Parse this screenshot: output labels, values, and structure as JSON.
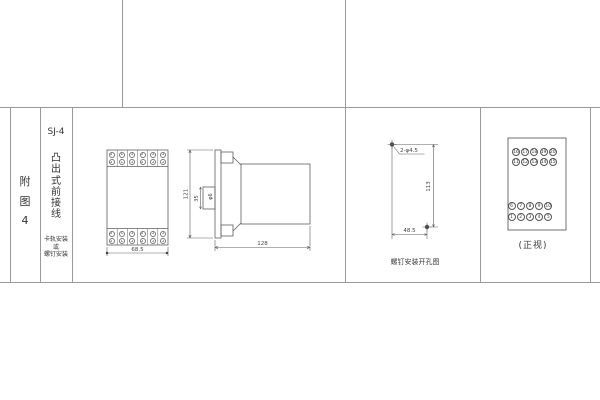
{
  "title_block": {
    "figure_label": "附图4",
    "model": "SJ-4",
    "type_label": "凸出式前接线",
    "mount_note_lines": [
      "卡轨安装",
      "或",
      "螺钉安装"
    ]
  },
  "front_view": {
    "width_dim": "68.5"
  },
  "side_view": {
    "height_dim": "121",
    "clip_height_dim": "35",
    "clip_hole_label": "φ6",
    "depth_dim": "128"
  },
  "drill_view": {
    "holes_label": "2-φ4.5",
    "height_dim": "113",
    "width_dim": "48.5",
    "caption": "螺钉安装开孔图"
  },
  "terminal_view": {
    "caption": "(正视)",
    "top_rows": [
      [
        "16",
        "17",
        "18",
        "19",
        "20"
      ],
      [
        "11",
        "12",
        "13",
        "14",
        "15"
      ]
    ],
    "bottom_rows": [
      [
        "6",
        "7",
        "8",
        "9",
        "10"
      ],
      [
        "1",
        "2",
        "3",
        "4",
        "5"
      ]
    ]
  }
}
